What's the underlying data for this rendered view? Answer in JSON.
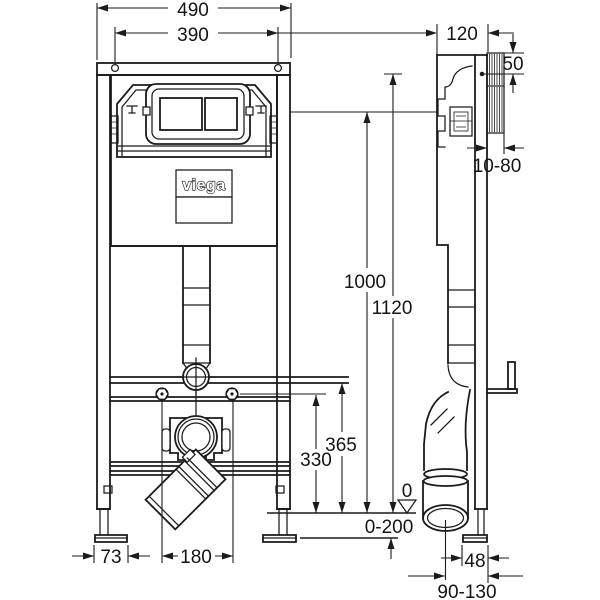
{
  "drawing": {
    "brand": "viega",
    "dims": {
      "frame_width": "490",
      "tank_width": "390",
      "frame_depth": "120",
      "top_clearance": "50",
      "flush_height": "1000",
      "frame_height": "1120",
      "outlet_bracket_height": "365",
      "fixing_height": "330",
      "floor_buildup": "0-200",
      "floor_datum": "0",
      "foot_offset": "73",
      "bolt_spacing": "180",
      "wall_clearance": "10-80",
      "foot_depth": "48",
      "outlet_wall_distance": "90-130"
    }
  }
}
